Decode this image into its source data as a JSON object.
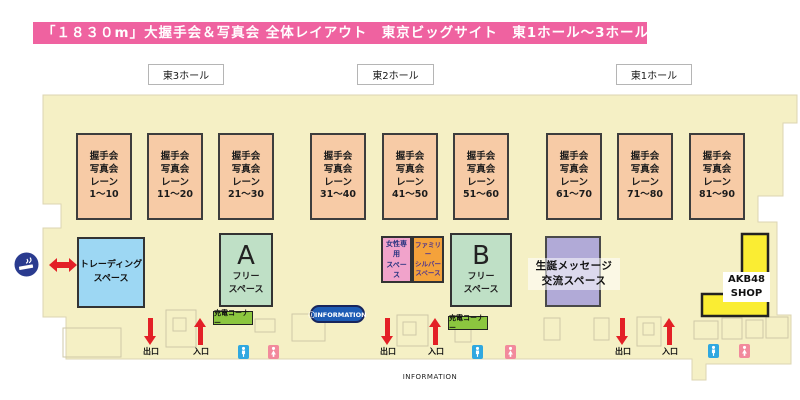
{
  "title": "「１８３０m」大握手会＆写真会 全体レイアウト　東京ビッグサイト　東1ホール〜3ホール",
  "halls": [
    {
      "label": "東3ホール"
    },
    {
      "label": "東2ホール"
    },
    {
      "label": "東1ホール"
    }
  ],
  "lanes": {
    "line1": "握手会",
    "line2": "写真会",
    "line3": "レーン",
    "ranges": [
      "1〜10",
      "11〜20",
      "21〜30",
      "31〜40",
      "41〜50",
      "51〜60",
      "61〜70",
      "71〜80",
      "81〜90"
    ]
  },
  "spaces": {
    "trading": {
      "line1": "トレーディング",
      "line2": "スペース"
    },
    "free_a": {
      "letter": "A",
      "line1": "フリー",
      "line2": "スペース"
    },
    "free_b": {
      "letter": "B",
      "line1": "フリー",
      "line2": "スペース"
    },
    "women": {
      "line1": "女性専用",
      "line2": "スペース"
    },
    "family": {
      "line1": "ファミリー",
      "line2": "シルバー",
      "line3": "スペース"
    },
    "birthday": {
      "line1": "生誕メッセージ",
      "line2": "交流スペース"
    },
    "shop": {
      "line1": "AKB48",
      "line2": "SHOP"
    }
  },
  "facilities": {
    "charge_label": "充電コーナー",
    "info_pill": "ⓘINFORMATION",
    "info_bottom": "INFORMATION",
    "exit_label": "出口",
    "entrance_label": "入口"
  },
  "icons": {
    "smoking": "smoking-area-icon",
    "double_arrow": "double-arrow-icon",
    "restroom_men": "restroom-men-icon",
    "restroom_women": "restroom-women-icon"
  },
  "colors": {
    "title_pink": "#EF62A0",
    "floor_cream": "#F5F0C5",
    "lane_salmon": "#F7CBA6",
    "trading_blue": "#9DD7F3",
    "free_green": "#BFE0C6",
    "women_pink": "#F1A3CB",
    "family_orange": "#F4A23B",
    "birthday_purple": "#B1AAD7",
    "shop_yellow": "#FAED33",
    "charge_green": "#8CC63F",
    "info_blue": "#1D5CB5",
    "arrow_red": "#E32026",
    "toilet_blue": "#2FA8E0",
    "toilet_pink": "#F28A9C",
    "smoking_navy": "#2A3B8F"
  }
}
